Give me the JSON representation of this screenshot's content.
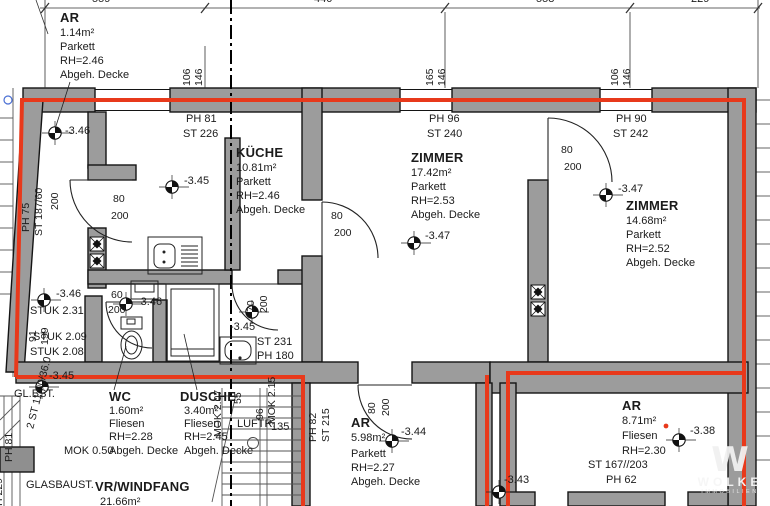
{
  "dimensions": {
    "top": [
      "559",
      "440",
      "558",
      "229"
    ],
    "wall_top_left_pair": [
      "106",
      "146"
    ],
    "wall_top_mid_pair": [
      "165",
      "146"
    ],
    "wall_top_right_pair": [
      "106",
      "146"
    ]
  },
  "rooms": {
    "ar_top": {
      "name": "AR",
      "area": "1.14m²",
      "floor": "Parkett",
      "height": "RH=2.46",
      "ceiling": "Abgeh. Decke",
      "level": "-3.46"
    },
    "kueche": {
      "name": "KÜCHE",
      "area": "10.81m²",
      "floor": "Parkett",
      "height": "RH=2.46",
      "ceiling": "Abgeh. Decke",
      "level": "-3.45",
      "ph": "PH 81",
      "st": "ST 226"
    },
    "zimmer_mid": {
      "name": "ZIMMER",
      "area": "17.42m²",
      "floor": "Parkett",
      "height": "RH=2.53",
      "ceiling": "Abgeh. Decke",
      "level": "-3.47",
      "ph": "PH 96",
      "st": "ST 240"
    },
    "zimmer_right": {
      "name": "ZIMMER",
      "area": "14.68m²",
      "floor": "Parkett",
      "height": "RH=2.52",
      "ceiling": "Abgeh. Decke",
      "level": "-3.47",
      "ph": "PH 90",
      "st": "ST 242"
    },
    "wc": {
      "name": "WC",
      "area": "1.60m²",
      "floor": "Fliesen",
      "height": "RH=2.28",
      "mok": "MOK 0.50",
      "ceiling": "Abgeh. Decke"
    },
    "dusche": {
      "name": "DUSCHE",
      "area": "3.40m²",
      "floor": "Fliesen",
      "height": "RH=2.45",
      "ceiling": "Abgeh. Decke"
    },
    "ar_mid": {
      "name": "AR",
      "area": "5.98m²",
      "floor": "Parkett",
      "height": "RH=2.27",
      "ceiling": "Abgeh. Decke",
      "level": "-3.44",
      "ph": "PH 82",
      "st": "ST 215"
    },
    "ar_right": {
      "name": "AR",
      "area": "8.71m²",
      "floor": "Fliesen",
      "height": "RH=2.30",
      "level": "-3.38",
      "st": "ST 167//203",
      "ph": "PH 62"
    },
    "vr": {
      "name": "VR/WINDFANG",
      "area": "21.66m²"
    }
  },
  "levels": {
    "entry_left": "-3.46",
    "wc_door": "-3.46",
    "basin": "-3.45",
    "left_lower": "-3.45",
    "ar_right_entry": "-3.43"
  },
  "doors": {
    "hall": {
      "w": "80",
      "h": "200"
    },
    "kueche_zimmer": {
      "w": "80",
      "h": "200"
    },
    "zimmer_right": {
      "w": "80",
      "h": "200"
    },
    "wc": {
      "w": "60",
      "h": "200"
    },
    "dusche": {
      "w": "70",
      "h": "200"
    },
    "ar_mid": {
      "w": "80",
      "h": "200"
    },
    "left_corridor_height": "200"
  },
  "annotations": {
    "ph75": "PH 75",
    "st18760": "ST 187/60",
    "stuk1": "STUK 2.31",
    "stuk2": "STUK 2.09",
    "stuk3": "STUK 2.08",
    "dim91": "91",
    "dim199": "199",
    "glbst": "GL.BST.",
    "stair_note": "2 ST 11.00/36.0",
    "ph81_left": "PH 81",
    "h229": "H 229",
    "glasbaust": "GLASBAUST.",
    "basin_st": "ST 231",
    "basin_ph": "PH 180",
    "luftr": "LUFTR.",
    "luftr_value": "135",
    "mok207": "MOK 2.07",
    "dim55": "55",
    "dim96": "96",
    "mok215": "MOK 2.15"
  },
  "logo": {
    "letter": "W",
    "name": "WOLKE",
    "subtitle": "IMMOBILIEN"
  },
  "colors": {
    "boundary_red": "#e8391b",
    "wall_gray": "#9c9c9c"
  }
}
